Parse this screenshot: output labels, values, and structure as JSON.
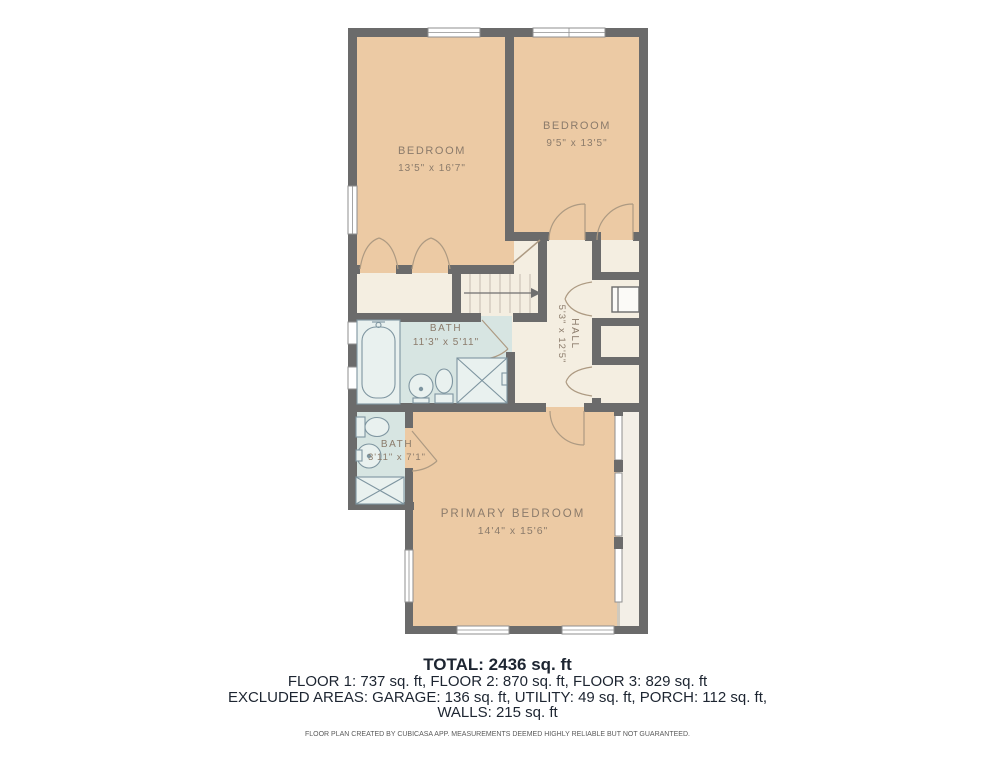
{
  "rooms": {
    "bedroom1": {
      "name": "BEDROOM",
      "dims": "13'5\" x 16'7\""
    },
    "bedroom2": {
      "name": "BEDROOM",
      "dims": "9'5\" x 13'5\""
    },
    "bath_main": {
      "name": "BATH",
      "dims": "11'3\" x 5'11\""
    },
    "hall": {
      "name": "HALL",
      "dims": "5'3\" x 12'5\""
    },
    "bath_small": {
      "name": "BATH",
      "dims": "3'11\" x 7'1\""
    },
    "primary": {
      "name": "PRIMARY BEDROOM",
      "dims": "14'4\" x 15'6\""
    }
  },
  "summary": {
    "total": "TOTAL: 2436 sq. ft",
    "floors": "FLOOR 1: 737 sq. ft, FLOOR 2: 870 sq. ft, FLOOR 3: 829 sq. ft",
    "excluded": "EXCLUDED AREAS: GARAGE: 136 sq. ft, UTILITY: 49 sq. ft, PORCH: 112 sq. ft,",
    "walls": "WALLS: 215 sq. ft",
    "disclaimer": "FLOOR PLAN CREATED BY CUBICASA APP. MEASUREMENTS DEEMED HIGHLY RELIABLE BUT NOT GUARANTEED."
  },
  "colors": {
    "wall": "#6b6b6b",
    "peach": "#eccaa4",
    "wet": "#d7e5e2",
    "cream": "#f4eee1",
    "strip": "#f3efe7",
    "door": "#ad9a82",
    "fixture": "#7e95a0",
    "label": "#8b7b6b",
    "ink": "#1d2531",
    "muted": "#5a5a5a"
  }
}
